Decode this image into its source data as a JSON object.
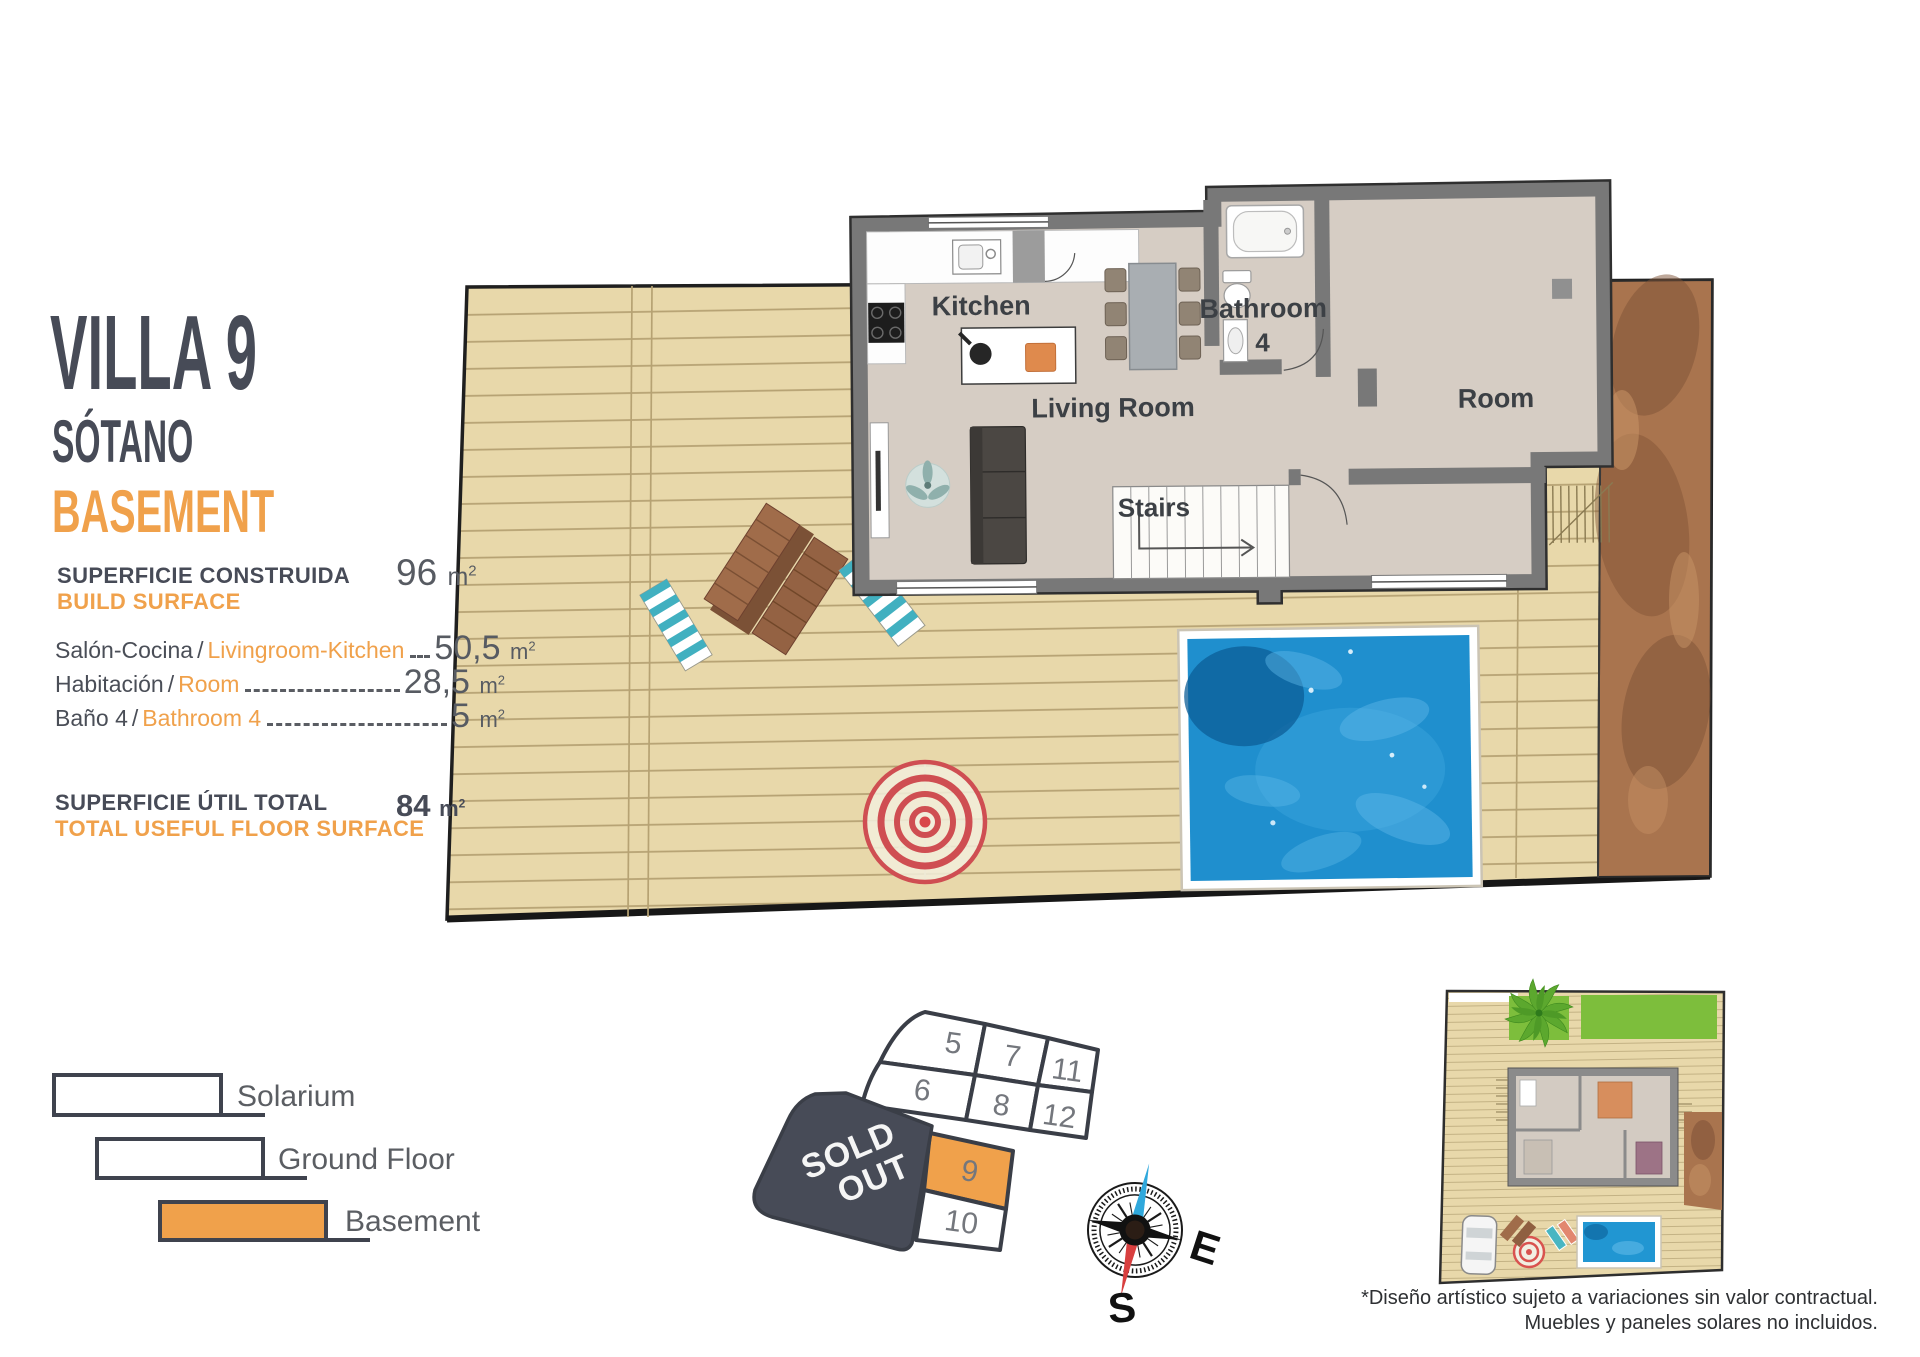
{
  "header": {
    "title": "VILLA 9",
    "subtitle_es": "SÓTANO",
    "subtitle_en": "BASEMENT"
  },
  "units": {
    "m": "m",
    "sup": "2"
  },
  "separators": {
    "slash": "/"
  },
  "build_surface": {
    "label_es": "SUPERFICIE CONSTRUIDA",
    "label_en": "BUILD SURFACE",
    "value": "96"
  },
  "rooms": [
    {
      "es": "Salón-Cocina",
      "en": "Livingroom-Kitchen",
      "value": "50,5"
    },
    {
      "es": "Habitación",
      "en": "Room",
      "value": "28,5"
    },
    {
      "es": "Baño 4",
      "en": "Bathroom 4",
      "value": "5"
    }
  ],
  "total": {
    "label_es": "SUPERFICIE ÚTIL TOTAL",
    "label_en": "TOTAL USEFUL FLOOR SURFACE",
    "value": "84"
  },
  "plan_labels": {
    "kitchen": "Kitchen",
    "living": "Living Room",
    "bathroom": "Bathroom",
    "bathroom_num": "4",
    "room": "Room",
    "stairs": "Stairs"
  },
  "site_map": {
    "plots": {
      "p5": "5",
      "p7": "7",
      "p11": "11",
      "p6": "6",
      "p8": "8",
      "p12": "12",
      "p9": "9",
      "p10": "10"
    },
    "sold_out_line1": "SOLD",
    "sold_out_line2": "OUT",
    "highlighted_plot": "9",
    "highlight_color": "#F0A14B"
  },
  "compass": {
    "east": "E",
    "south": "S"
  },
  "legend": [
    {
      "label": "Solarium"
    },
    {
      "label": "Ground Floor"
    },
    {
      "label": "Basement"
    }
  ],
  "disclaimer": {
    "line1": "*Diseño artístico sujeto a variaciones sin valor contractual.",
    "line2": "Muebles y paneles solares no incluidos."
  },
  "colors": {
    "accent_orange": "#F0A14B",
    "dark": "#474B57",
    "deck": "#E8D8AA",
    "pool": "#1F8FCE"
  }
}
